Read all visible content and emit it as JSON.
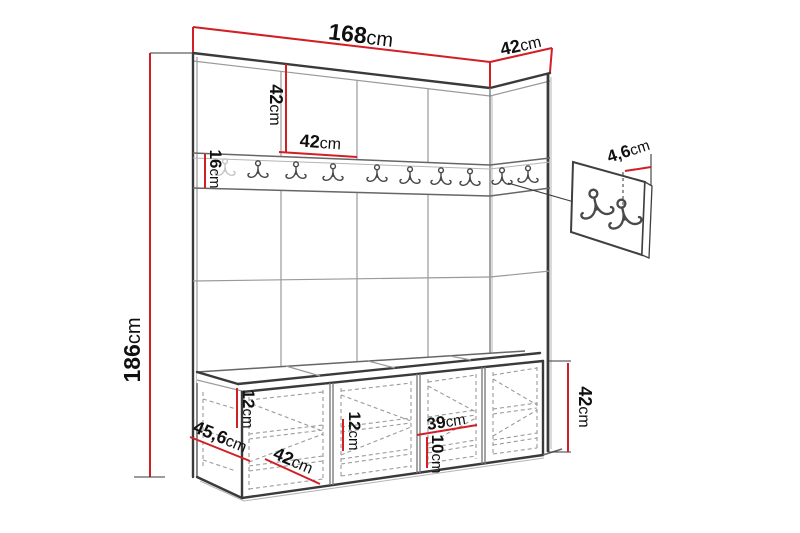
{
  "diagram": {
    "type": "furniture-dimension-drawing",
    "subject": "hallway set: wall panels with coat hook rail and storage bench",
    "colors": {
      "dimension_line": "#d21f26",
      "outline": "#3a3a3a",
      "panel_line": "#9a9a9a",
      "text": "#101010",
      "background": "#ffffff"
    },
    "dimensions": {
      "total_width": {
        "value": "168",
        "unit": "cm"
      },
      "side_panel_width": {
        "value": "42",
        "unit": "cm"
      },
      "total_height": {
        "value": "186",
        "unit": "cm"
      },
      "panel_height": {
        "value": "42",
        "unit": "cm"
      },
      "panel_width": {
        "value": "42",
        "unit": "cm"
      },
      "rail_height": {
        "value": "16",
        "unit": "cm"
      },
      "hook_depth": {
        "value": "4,6",
        "unit": "cm"
      },
      "cushion_thickness": {
        "value": "12",
        "unit": "cm"
      },
      "shelf_spacing": {
        "value": "12",
        "unit": "cm"
      },
      "compartment_width": {
        "value": "39",
        "unit": "cm"
      },
      "compartment_height": {
        "value": "10",
        "unit": "cm"
      },
      "bench_depth": {
        "value": "45,6",
        "unit": "cm"
      },
      "bench_front_width": {
        "value": "42",
        "unit": "cm"
      },
      "bench_height": {
        "value": "42",
        "unit": "cm"
      }
    },
    "icons": {
      "hook": "double-coat-hook",
      "rail_hook_count": 10,
      "detail_hook_count": 2
    }
  }
}
